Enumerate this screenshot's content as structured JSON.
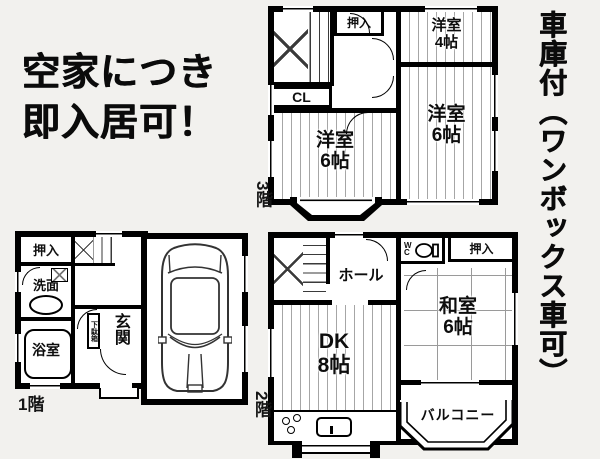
{
  "colors": {
    "background": "#f2f1ee",
    "wall": "#000000",
    "floor_stripe": "#a6a6a6",
    "text": "#111111"
  },
  "headline": {
    "line1": "空家につき",
    "line2": "即入居可！"
  },
  "side_note": {
    "text": "車庫付（ワンボックス車可）"
  },
  "floor3": {
    "label": "3階",
    "oshiire": "押入",
    "closet": "CL",
    "room_top_right": {
      "name": "洋室",
      "size": "4帖"
    },
    "room_right": {
      "name": "洋室",
      "size": "6帖"
    },
    "room_left": {
      "name": "洋室",
      "size": "6帖"
    }
  },
  "floor2": {
    "label": "2階",
    "hall": "ホール",
    "wc": "WC",
    "oshiire": "押入",
    "washitsu": {
      "name": "和室",
      "size": "6帖"
    },
    "dk": {
      "name": "DK",
      "size": "8帖"
    },
    "balcony": "バルコニー"
  },
  "floor1": {
    "label": "1階",
    "oshiire": "押入",
    "washroom": "洗面",
    "bathroom": "浴室",
    "entrance": "玄関",
    "shoe_cabinet": "下駄箱"
  }
}
